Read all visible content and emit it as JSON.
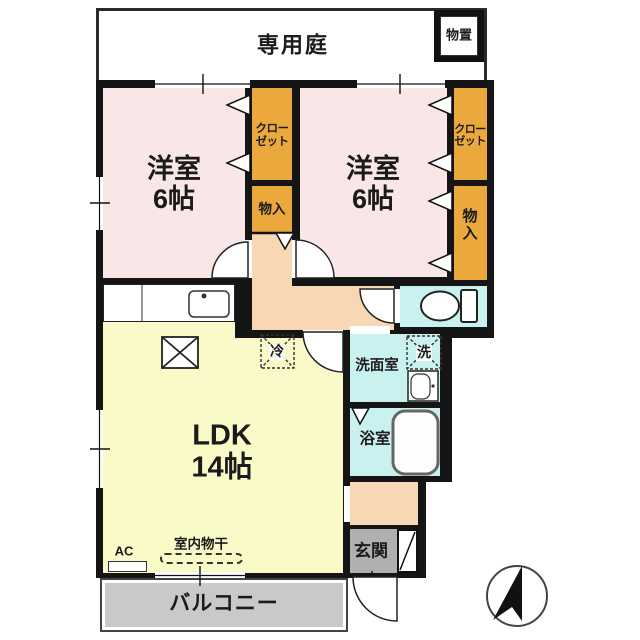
{
  "garden": {
    "label": "専用庭"
  },
  "shed": {
    "label": "物置"
  },
  "bedroom1": {
    "name": "洋室",
    "size": "6帖"
  },
  "bedroom2": {
    "name": "洋室",
    "size": "6帖"
  },
  "closet1": {
    "line1": "クロー",
    "line2": "ゼット"
  },
  "closet2": {
    "line1": "クロー",
    "line2": "ゼット"
  },
  "storage1": {
    "label": "物入"
  },
  "storage2": {
    "char1": "物",
    "char2": "入"
  },
  "ldk": {
    "name": "LDK",
    "size": "14帖"
  },
  "fridge": {
    "label": "冷"
  },
  "washroom": {
    "label": "洗面室"
  },
  "washer": {
    "label": "洗"
  },
  "bathroom": {
    "label": "浴室"
  },
  "entrance": {
    "label": "玄関"
  },
  "balcony": {
    "label": "バルコニー"
  },
  "drying": {
    "label": "室内物干"
  },
  "ac": {
    "label": "AC"
  },
  "colors": {
    "wall": "#151515",
    "bedroom": "#f8e7e6",
    "closet": "#eba93d",
    "hallway": "#f8d8b4",
    "ldk": "#fafac9",
    "wet_area": "#c9f1ef",
    "entrance": "#b0b0b0",
    "balcony": "#c9c9c9"
  }
}
